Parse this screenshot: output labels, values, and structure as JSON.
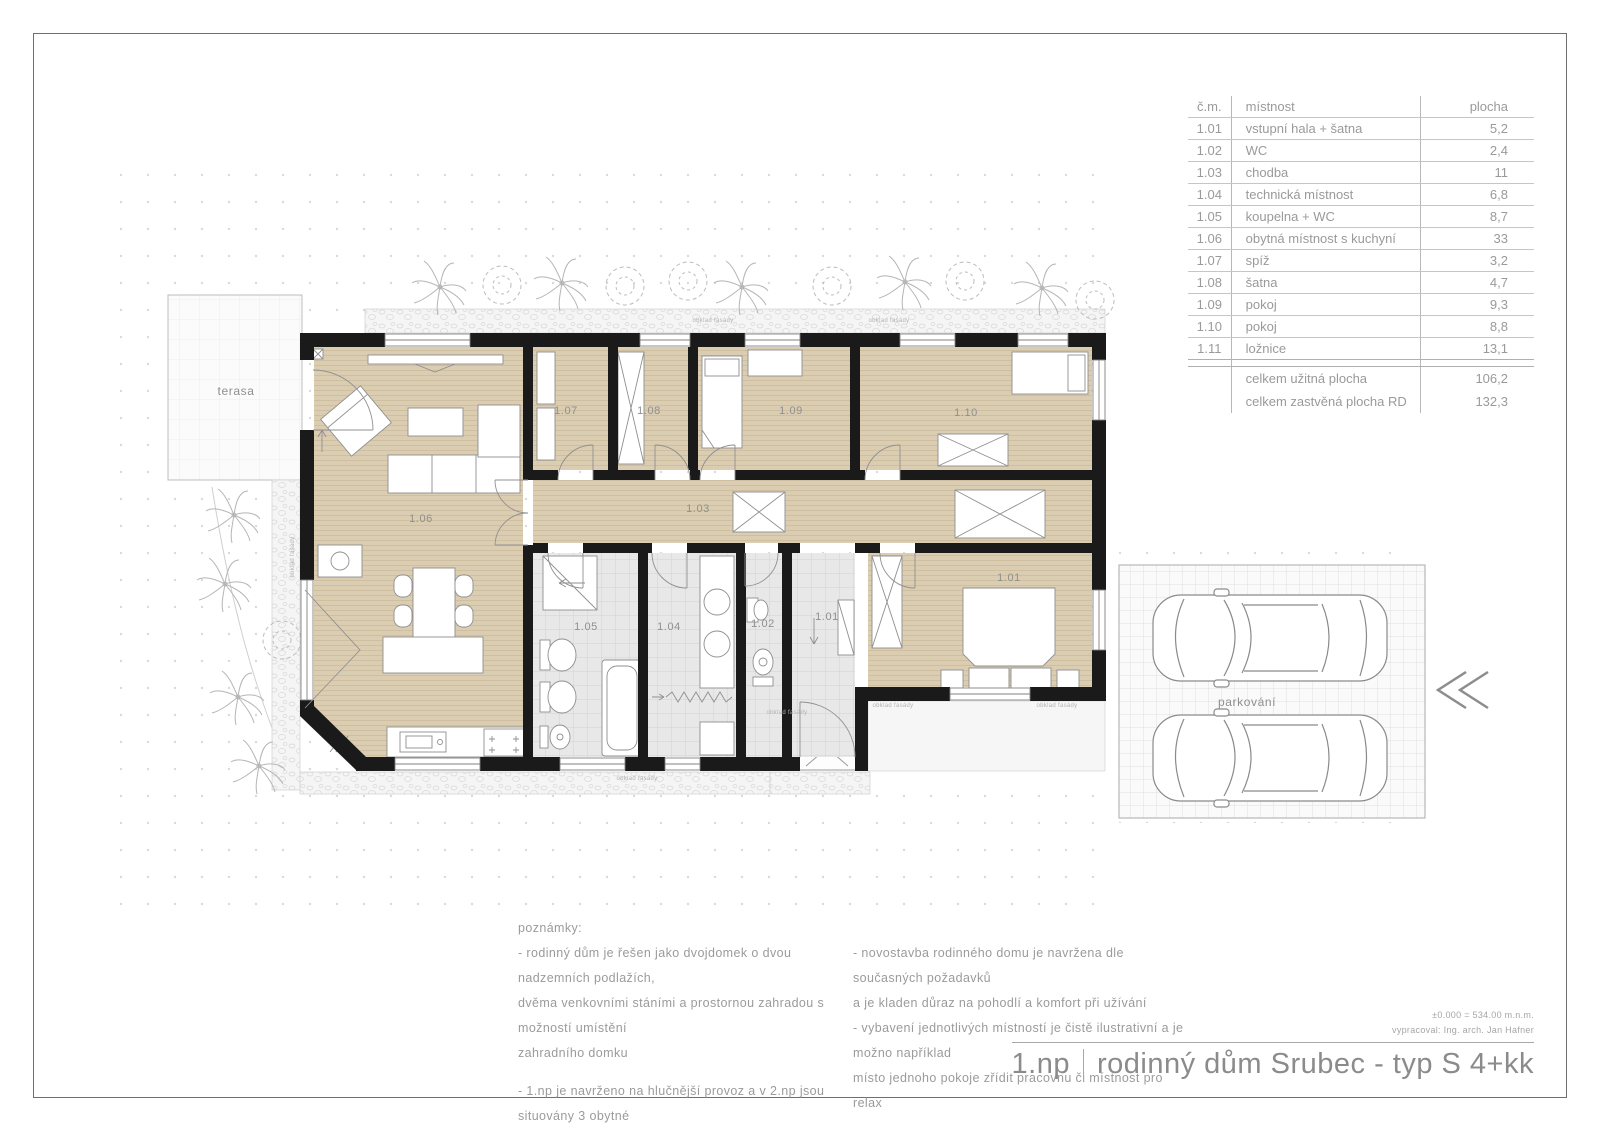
{
  "room_table": {
    "headers": {
      "number": "č.m.",
      "name": "místnost",
      "area": "plocha"
    },
    "rows": [
      {
        "n": "1.01",
        "name": "vstupní hala + šatna",
        "a": "5,2"
      },
      {
        "n": "1.02",
        "name": "WC",
        "a": "2,4"
      },
      {
        "n": "1.03",
        "name": "chodba",
        "a": "11"
      },
      {
        "n": "1.04",
        "name": "technická místnost",
        "a": "6,8"
      },
      {
        "n": "1.05",
        "name": "koupelna + WC",
        "a": "8,7"
      },
      {
        "n": "1.06",
        "name": "obytná místnost s kuchyní",
        "a": "33"
      },
      {
        "n": "1.07",
        "name": "spíž",
        "a": "3,2"
      },
      {
        "n": "1.08",
        "name": "šatna",
        "a": "4,7"
      },
      {
        "n": "1.09",
        "name": "pokoj",
        "a": "9,3"
      },
      {
        "n": "1.10",
        "name": "pokoj",
        "a": "8,8"
      },
      {
        "n": "1.11",
        "name": "ložnice",
        "a": "13,1"
      }
    ],
    "totals": [
      {
        "label": "celkem užitná plocha",
        "value": "106,2"
      },
      {
        "label": "celkem zastvěná plocha RD",
        "value": "132,3"
      }
    ]
  },
  "plan": {
    "terrace_label": "terasa",
    "parking_label": "parkování",
    "facade_label": "obklad fasády",
    "rooms": {
      "living": "1.06",
      "pantry": "1.07",
      "closet": "1.08",
      "room1": "1.09",
      "room2": "1.10",
      "corridor": "1.03",
      "bathroom": "1.05",
      "utility": "1.04",
      "wc": "1.02",
      "entry_hall": "1.01",
      "bedroom": "1.01"
    }
  },
  "notes": {
    "title": "poznámky:",
    "left": [
      "- rodinný dům je řešen jako dvojdomek o dvou nadzemních podlažích,",
      "dvěma venkovními stáními a prostornou zahradou s možností umístění",
      "zahradního domku",
      "- 1.np je navrženo na hlučnější provoz a v 2.np jsou situovány 3 obytné",
      "místnosti, tak aby byl zaručen klid a soukromí v jednotlivých pokojích"
    ],
    "right": [
      "- novostavba rodinného domu je navržena dle současných požadavků",
      "a je kladen důraz na pohodlí a komfort při užívání",
      "- vybavení jednotlivých místností je čistě ilustrativní a je možno například",
      "místo jednoho pokoje zřídit pracovnu či místnost pro relax"
    ]
  },
  "title_block": {
    "elevation": "±0.000 = 534.00 m.n.m.",
    "author": "vypracoval: Ing. arch. Jan Hafner",
    "floor": "1.np",
    "title": "rodinný dům Srubec - typ S 4+kk"
  },
  "colors": {
    "wall": "#1a1a1a",
    "wood_floor": "#dbcdb2",
    "tile_floor": "#e8e8e8",
    "drawing_text": "#8f8f8f"
  }
}
